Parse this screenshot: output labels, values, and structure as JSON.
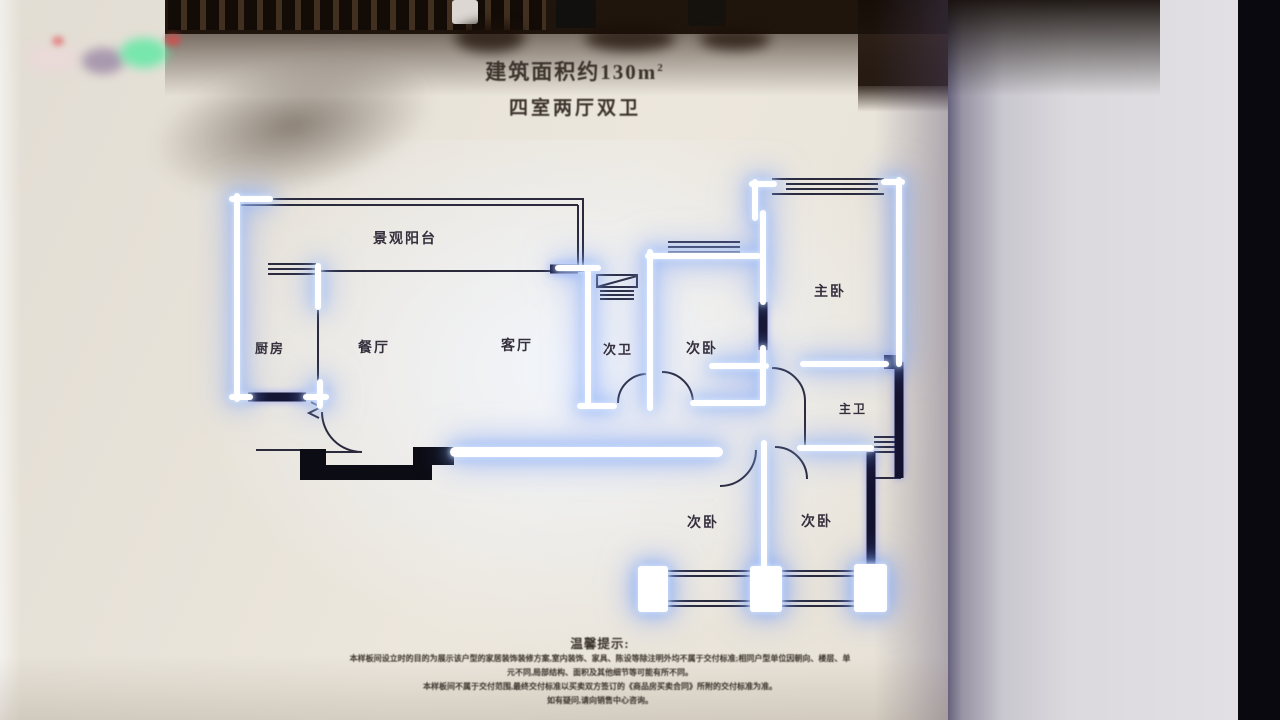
{
  "scene": {
    "poster_bg": "#e9e4d9",
    "panel_bg": "#d7d5d9",
    "right_edge_black": "#0a090f",
    "shelf_wood": "#20150d",
    "glow_core": "#ffffff",
    "glow_halo": "#85aef5",
    "wall_navy": "#13122e",
    "wall_black": "#0c0c14",
    "line_dark": "#2a2a3c",
    "label_color": "#352f3d"
  },
  "header": {
    "area_text": "建筑面积约130m",
    "area_sup": "2",
    "layout_text": "四室两厅双卫"
  },
  "floorplan": {
    "rooms": {
      "balcony": "景观阳台",
      "kitchen": "厨房",
      "dining": "餐厅",
      "living": "客厅",
      "bath_second": "次卫",
      "bed_second_top": "次卧",
      "bed_master": "主卧",
      "bath_master": "主卫",
      "bed_second_bottom_left": "次卧",
      "bed_second_bottom_right": "次卧"
    }
  },
  "footer": {
    "title": "温馨提示:",
    "lines": [
      "本样板间设立时的目的为展示该户型的家居装饰装修方案,室内装饰、家具、陈设等除注明外均不属于交付标准;相同户型单位因朝向、楼层、单",
      "元不同,局部结构、面积及其他细节等可能有所不同。",
      "本样板间不属于交付范围,最终交付标准以买卖双方签订的《商品房买卖合同》所附的交付标准为准。",
      "如有疑问,请向销售中心咨询。"
    ]
  }
}
